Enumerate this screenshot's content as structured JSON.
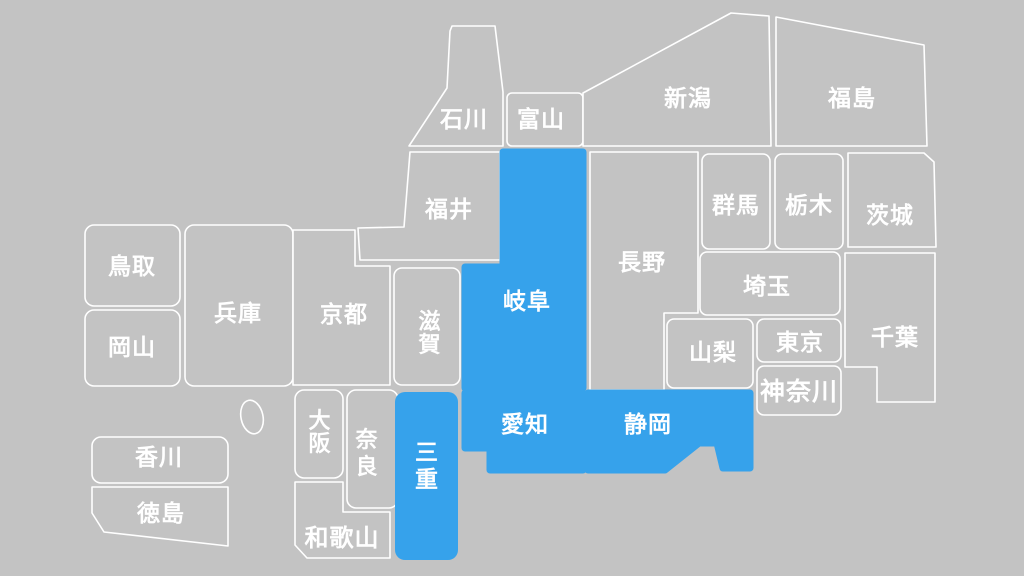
{
  "map": {
    "background_color": "#c3c3c3",
    "tile_color": "#c3c3c3",
    "outline_color": "#ffffff",
    "label_color": "#ffffff",
    "highlight_color": "#36a2eb",
    "highlighted_prefectures": [
      "岐阜",
      "三重",
      "愛知",
      "静岡"
    ],
    "prefectures": {
      "ishikawa": {
        "label": "石川",
        "highlighted": false
      },
      "toyama": {
        "label": "富山",
        "highlighted": false
      },
      "niigata": {
        "label": "新潟",
        "highlighted": false
      },
      "fukushima": {
        "label": "福島",
        "highlighted": false
      },
      "fukui": {
        "label": "福井",
        "highlighted": false
      },
      "gunma": {
        "label": "群馬",
        "highlighted": false
      },
      "tochigi": {
        "label": "栃木",
        "highlighted": false
      },
      "ibaraki": {
        "label": "茨城",
        "highlighted": false
      },
      "nagano": {
        "label": "長野",
        "highlighted": false
      },
      "saitama": {
        "label": "埼玉",
        "highlighted": false
      },
      "yamanashi": {
        "label": "山梨",
        "highlighted": false
      },
      "tokyo": {
        "label": "東京",
        "highlighted": false
      },
      "chiba": {
        "label": "千葉",
        "highlighted": false
      },
      "kanagawa": {
        "label": "神奈川",
        "highlighted": false
      },
      "tottori": {
        "label": "鳥取",
        "highlighted": false
      },
      "hyogo": {
        "label": "兵庫",
        "highlighted": false
      },
      "okayama": {
        "label": "岡山",
        "highlighted": false
      },
      "kyoto": {
        "label": "京都",
        "highlighted": false
      },
      "shiga": {
        "label": "滋賀",
        "highlighted": false
      },
      "gifu": {
        "label": "岐阜",
        "highlighted": true
      },
      "osaka": {
        "label": "大阪",
        "highlighted": false
      },
      "nara": {
        "label": "奈良",
        "highlighted": false
      },
      "mie": {
        "label": "三重",
        "highlighted": true
      },
      "aichi": {
        "label": "愛知",
        "highlighted": true
      },
      "shizuoka": {
        "label": "静岡",
        "highlighted": true
      },
      "wakayama": {
        "label": "和歌山",
        "highlighted": false
      },
      "kagawa": {
        "label": "香川",
        "highlighted": false
      },
      "tokushima": {
        "label": "徳島",
        "highlighted": false
      }
    }
  }
}
